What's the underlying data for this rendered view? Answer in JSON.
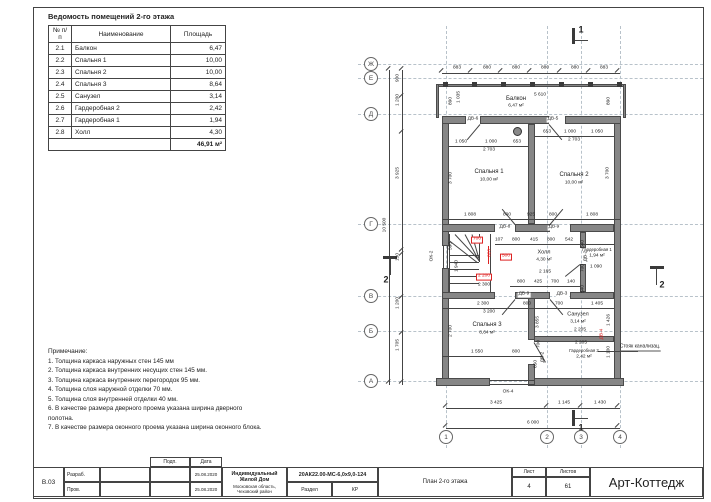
{
  "room_table": {
    "title": "Ведомость помещений 2-го этажа",
    "headers": [
      "№ п/п",
      "Наименование",
      "Площадь"
    ],
    "rows": [
      [
        "2.1",
        "Балкон",
        "6,47"
      ],
      [
        "2.2",
        "Спальня 1",
        "10,00"
      ],
      [
        "2.3",
        "Спальня 2",
        "10,00"
      ],
      [
        "2.4",
        "Спальня 3",
        "8,64"
      ],
      [
        "2.5",
        "Санузел",
        "3,14"
      ],
      [
        "2.6",
        "Гардеробная 2",
        "2,42"
      ],
      [
        "2.7",
        "Гардеробная 1",
        "1,94"
      ],
      [
        "2.8",
        "Холл",
        "4,30"
      ]
    ],
    "total": "46,91 м²"
  },
  "notes": {
    "title": "Примечание:",
    "items": [
      "1. Толщина каркаса наружных стен 145 мм",
      "2. Толщина каркаса внутренних несущих стен 145 мм.",
      "3. Толщина каркаса внутренних перегородок 95 мм.",
      "4. Толщина слоя наружной отделки 70 мм.",
      "5. Толщина слоя внутренней отделки 40 мм.",
      "6. В качестве размера дверного проема указана ширина дверного полотна.",
      "7. В качестве размера оконного проема указана ширина оконного блока."
    ]
  },
  "plan": {
    "grid": {
      "row_bubbles": [
        [
          "Ж",
          371,
          64
        ],
        [
          "Е",
          371,
          78
        ],
        [
          "Д",
          371,
          114
        ],
        [
          "Г",
          371,
          224
        ],
        [
          "В",
          371,
          296
        ],
        [
          "Б",
          371,
          331
        ],
        [
          "А",
          371,
          381
        ]
      ],
      "col_bubbles": [
        [
          "1",
          446,
          437
        ],
        [
          "2",
          547,
          437
        ],
        [
          "3",
          581,
          437
        ],
        [
          "4",
          620,
          437
        ]
      ]
    },
    "labels": [
      {
        "t": "883",
        "x": 457,
        "y": 69
      },
      {
        "t": "880",
        "x": 487,
        "y": 69
      },
      {
        "t": "880",
        "x": 516,
        "y": 69
      },
      {
        "t": "880",
        "x": 545,
        "y": 69
      },
      {
        "t": "880",
        "x": 575,
        "y": 69
      },
      {
        "t": "883",
        "x": 604,
        "y": 69
      },
      {
        "t": "Балкон",
        "x": 516,
        "y": 99,
        "fs": 6,
        "n": "room-label"
      },
      {
        "t": "6,47 м²",
        "x": 516,
        "y": 107,
        "n": "room-area"
      },
      {
        "t": "5 610",
        "x": 540,
        "y": 96
      },
      {
        "t": "890",
        "x": 452,
        "y": 101,
        "r": 1
      },
      {
        "t": "1 035",
        "x": 460,
        "y": 97,
        "r": 1
      },
      {
        "t": "890",
        "x": 610,
        "y": 101,
        "r": 1
      },
      {
        "t": "1 050",
        "x": 461,
        "y": 143
      },
      {
        "t": "1 000",
        "x": 491,
        "y": 143
      },
      {
        "t": "653",
        "x": 517,
        "y": 143
      },
      {
        "t": "2 703",
        "x": 489,
        "y": 151
      },
      {
        "t": "Спальня 1",
        "x": 489,
        "y": 172,
        "fs": 6,
        "n": "room-label"
      },
      {
        "t": "10,00 м²",
        "x": 489,
        "y": 181,
        "n": "room-area"
      },
      {
        "t": "3 700",
        "x": 452,
        "y": 178,
        "r": 1
      },
      {
        "t": "653",
        "x": 547,
        "y": 133
      },
      {
        "t": "1 000",
        "x": 570,
        "y": 133
      },
      {
        "t": "1 050",
        "x": 597,
        "y": 133
      },
      {
        "t": "2 703",
        "x": 574,
        "y": 141
      },
      {
        "t": "Спальня 2",
        "x": 574,
        "y": 175,
        "fs": 6,
        "n": "room-label"
      },
      {
        "t": "10,00 м²",
        "x": 574,
        "y": 184,
        "n": "room-area"
      },
      {
        "t": "3 700",
        "x": 609,
        "y": 173,
        "r": 1
      },
      {
        "t": "1 808",
        "x": 470,
        "y": 216
      },
      {
        "t": "800",
        "x": 507,
        "y": 216
      },
      {
        "t": "925",
        "x": 531,
        "y": 216
      },
      {
        "t": "800",
        "x": 553,
        "y": 216
      },
      {
        "t": "1 808",
        "x": 592,
        "y": 216
      },
      {
        "t": "107",
        "x": 499,
        "y": 241
      },
      {
        "t": "800",
        "x": 516,
        "y": 241
      },
      {
        "t": "415",
        "x": 534,
        "y": 241
      },
      {
        "t": "800",
        "x": 551,
        "y": 241
      },
      {
        "t": "542",
        "x": 569,
        "y": 241
      },
      {
        "t": "Холл",
        "x": 544,
        "y": 253,
        "fs": 5.5,
        "n": "room-label"
      },
      {
        "t": "4,30 м²",
        "x": 544,
        "y": 261,
        "n": "room-area"
      },
      {
        "t": "2 165",
        "x": 545,
        "y": 273
      },
      {
        "t": "800",
        "x": 521,
        "y": 283
      },
      {
        "t": "425",
        "x": 538,
        "y": 283
      },
      {
        "t": "700",
        "x": 555,
        "y": 283
      },
      {
        "t": "140",
        "x": 571,
        "y": 283
      },
      {
        "t": "Гардеробная 1",
        "x": 597,
        "y": 250,
        "fs": 4.3,
        "n": "room-label"
      },
      {
        "t": "1,94 м²",
        "x": 597,
        "y": 257,
        "n": "room-area"
      },
      {
        "t": "1 090",
        "x": 596,
        "y": 268
      },
      {
        "t": "540",
        "x": 584,
        "y": 244,
        "r": 1
      },
      {
        "t": "700",
        "x": 584,
        "y": 268,
        "r": 1
      },
      {
        "t": "540",
        "x": 584,
        "y": 289,
        "r": 1
      },
      {
        "t": "700",
        "x": 477,
        "y": 240,
        "c": 1,
        "k": 1
      },
      {
        "t": "820",
        "x": 491,
        "y": 253,
        "r": 1,
        "c": 1
      },
      {
        "t": "500",
        "x": 506,
        "y": 257,
        "c": 1,
        "k": 1
      },
      {
        "t": "2 200",
        "x": 484,
        "y": 277,
        "c": 1,
        "k": 1
      },
      {
        "t": "2 300",
        "x": 484,
        "y": 286
      },
      {
        "t": "590",
        "x": 452,
        "y": 246,
        "r": 1
      },
      {
        "t": "1 940",
        "x": 458,
        "y": 266,
        "r": 1
      },
      {
        "t": "2 300",
        "x": 483,
        "y": 305
      },
      {
        "t": "800",
        "x": 527,
        "y": 305
      },
      {
        "t": "700",
        "x": 559,
        "y": 305
      },
      {
        "t": "1 405",
        "x": 597,
        "y": 305
      },
      {
        "t": "3 200",
        "x": 489,
        "y": 313
      },
      {
        "t": "Спальня 3",
        "x": 487,
        "y": 325,
        "fs": 6,
        "n": "room-label"
      },
      {
        "t": "8,64 м²",
        "x": 487,
        "y": 334,
        "n": "room-area"
      },
      {
        "t": "2 700",
        "x": 452,
        "y": 331,
        "r": 1
      },
      {
        "t": "Санузел",
        "x": 578,
        "y": 315,
        "fs": 5.5,
        "n": "room-label"
      },
      {
        "t": "3,14 м²",
        "x": 578,
        "y": 323,
        "n": "room-area"
      },
      {
        "t": "2 205",
        "x": 580,
        "y": 331
      },
      {
        "t": "1 426",
        "x": 610,
        "y": 320,
        "r": 1
      },
      {
        "t": "2 205",
        "x": 581,
        "y": 344
      },
      {
        "t": "Гардеробная 2",
        "x": 584,
        "y": 351,
        "fs": 4.3,
        "n": "room-label"
      },
      {
        "t": "2,42 м²",
        "x": 584,
        "y": 358,
        "n": "room-area"
      },
      {
        "t": "1 100",
        "x": 610,
        "y": 352,
        "r": 1
      },
      {
        "t": "3 855",
        "x": 539,
        "y": 322,
        "r": 1
      },
      {
        "t": "700",
        "x": 540,
        "y": 344,
        "r": 1
      },
      {
        "t": "650",
        "x": 537,
        "y": 364,
        "r": 1
      },
      {
        "t": "1 550",
        "x": 477,
        "y": 353
      },
      {
        "t": "800",
        "x": 516,
        "y": 353
      },
      {
        "t": "3 425",
        "x": 496,
        "y": 404
      },
      {
        "t": "1 145",
        "x": 564,
        "y": 404
      },
      {
        "t": "1 430",
        "x": 600,
        "y": 404
      },
      {
        "t": "6 000",
        "x": 533,
        "y": 424
      },
      {
        "t": "900",
        "x": 399,
        "y": 78,
        "r": 1
      },
      {
        "t": "1 200",
        "x": 399,
        "y": 100,
        "r": 1
      },
      {
        "t": "3 925",
        "x": 399,
        "y": 173,
        "r": 1
      },
      {
        "t": "150",
        "x": 399,
        "y": 257,
        "r": 1
      },
      {
        "t": "1 200",
        "x": 399,
        "y": 303,
        "r": 1
      },
      {
        "t": "1 705",
        "x": 399,
        "y": 345,
        "r": 1
      },
      {
        "t": "10 500",
        "x": 386,
        "y": 225,
        "r": 1
      },
      {
        "t": "ДВ-6",
        "x": 473,
        "y": 120,
        "bg": 1,
        "n": "door-label"
      },
      {
        "t": "ДВ-5",
        "x": 553,
        "y": 120,
        "bg": 1,
        "n": "door-label"
      },
      {
        "t": "ДВ-8",
        "x": 505,
        "y": 228,
        "bg": 1,
        "n": "door-label"
      },
      {
        "t": "ДВ-9",
        "x": 554,
        "y": 228,
        "bg": 1,
        "n": "door-label"
      },
      {
        "t": "ДВ-9",
        "x": 524,
        "y": 295,
        "bg": 1,
        "n": "door-label"
      },
      {
        "t": "ДВ-3",
        "x": 562,
        "y": 295,
        "bg": 1,
        "n": "door-label"
      },
      {
        "t": "ДВ-2",
        "x": 587,
        "y": 256,
        "r": 1,
        "n": "door-label"
      },
      {
        "t": "ДВ-2",
        "x": 544,
        "y": 357,
        "r": 1,
        "n": "door-label"
      },
      {
        "t": "ДВ-4",
        "x": 603,
        "y": 334,
        "r": 1,
        "c": 1,
        "n": "door-label"
      },
      {
        "t": "ОК-2",
        "x": 433,
        "y": 256,
        "r": 1,
        "n": "window-label"
      },
      {
        "t": "ОК-4",
        "x": 508,
        "y": 393,
        "n": "window-label"
      },
      {
        "t": "Стояк канализац.",
        "x": 640,
        "y": 348,
        "fs": 5,
        "u": 1,
        "n": "annotation-sewer-stack"
      },
      {
        "t": "1",
        "x": 581,
        "y": 30,
        "fs": 9,
        "b": 1,
        "n": "section-marker-label"
      },
      {
        "t": "1",
        "x": 581,
        "y": 428,
        "fs": 9,
        "b": 1,
        "n": "section-marker-label"
      },
      {
        "t": "2",
        "x": 386,
        "y": 280,
        "fs": 9,
        "b": 1,
        "n": "section-marker-label"
      },
      {
        "t": "2",
        "x": 662,
        "y": 285,
        "fs": 9,
        "b": 1,
        "n": "section-marker-label"
      }
    ]
  },
  "title_block": {
    "sheet_code": "В.03",
    "role1": "Разраб.",
    "role2": "Пров.",
    "sig_header": "Подп.",
    "date_header": "Дата",
    "date1": "25.08.2020",
    "date2": "25.08.2020",
    "project_line1": "Индивидуальный Жилой Дом",
    "project_line2": "Московская область, Чеховский район",
    "doc_code": "20АК22.00-МС-6,0х9,0-124",
    "section_label": "Раздел",
    "section_value": "КР",
    "sheet_title": "План 2-го этажа",
    "sheet_label": "Лист",
    "sheets_label": "Листов",
    "sheet_number": "4",
    "sheets_total": "61",
    "company": "Арт-Коттедж"
  }
}
